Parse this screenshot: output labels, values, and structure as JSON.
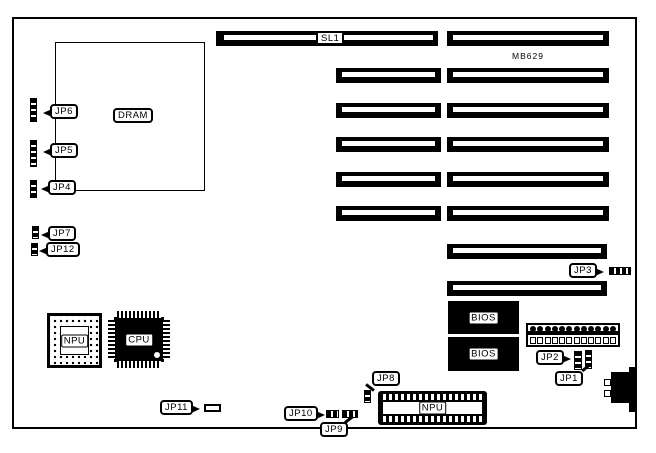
{
  "board": {
    "model": "MB629",
    "slot_label": "SL1",
    "dram_label": "DRAM",
    "bios_label_1": "BIOS",
    "bios_label_2": "BIOS",
    "npu_chip_label": "NPU",
    "cpu_chip_label": "CPU",
    "npu_socket_label": "NPU",
    "jumpers": {
      "jp1": "JP1",
      "jp2": "JP2",
      "jp3": "JP3",
      "jp4": "JP4",
      "jp5": "JP5",
      "jp6": "JP6",
      "jp7": "JP7",
      "jp8": "JP8",
      "jp9": "JP9",
      "jp10": "JP10",
      "jp11": "JP11",
      "jp12": "JP12"
    },
    "power_connector": {
      "pin_count": 12
    },
    "colors": {
      "line": "#000000",
      "background": "#ffffff"
    }
  }
}
